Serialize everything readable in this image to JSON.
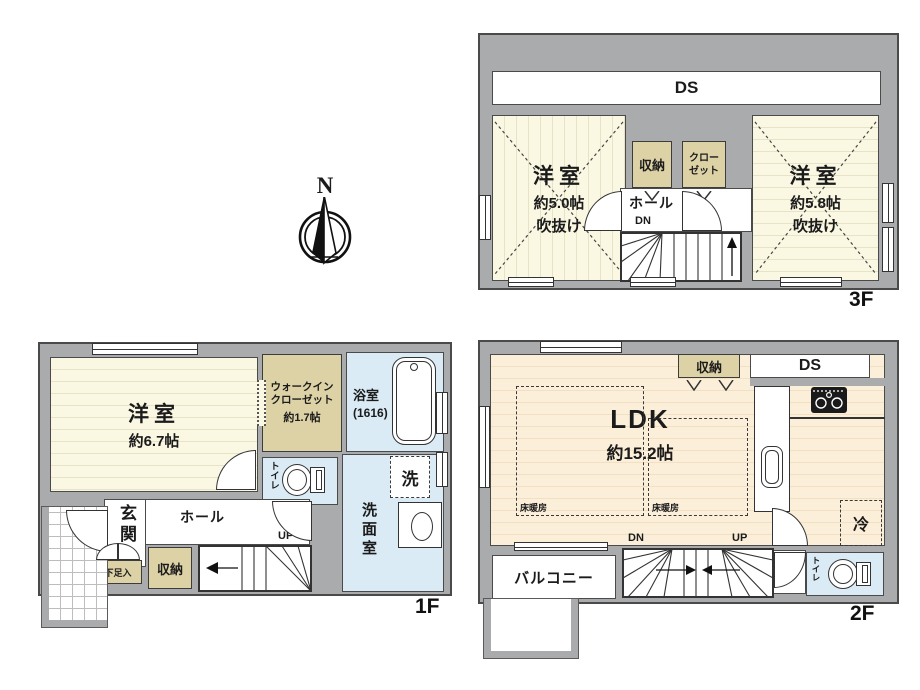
{
  "compass": {
    "north_label": "N"
  },
  "floor_3f": {
    "floor_label": "3F",
    "ds_label": "DS",
    "room_left": {
      "name": "洋室",
      "size": "約5.0帖",
      "void": "吹抜け"
    },
    "room_right": {
      "name": "洋室",
      "size": "約5.8帖",
      "void": "吹抜け"
    },
    "storage_label": "収納",
    "closet_line1": "クロー",
    "closet_line2": "ゼット",
    "hall_label": "ホール",
    "down_label": "DN"
  },
  "floor_1f": {
    "floor_label": "1F",
    "room": {
      "name": "洋室",
      "size": "約6.7帖"
    },
    "wic_line1": "ウォークイン",
    "wic_line2": "クローゼット",
    "wic_size": "約1.7帖",
    "bath_name": "浴室",
    "bath_size": "(1616)",
    "toilet_label": "トイレ",
    "laundry_label": "洗",
    "washroom_label": "洗面室",
    "entrance_label": "玄関",
    "hall_label": "ホール",
    "up_label": "UP",
    "shoe_label": "下足入",
    "storage_label": "収納"
  },
  "floor_2f": {
    "floor_label": "2F",
    "ldk": {
      "name": "LDK",
      "size": "約15.2帖"
    },
    "floor_heating_label": "床暖房",
    "storage_label": "収納",
    "ds_label": "DS",
    "fridge_label": "冷",
    "toilet_label": "トイレ",
    "balcony_label": "バルコニー",
    "down_label": "DN",
    "up_label": "UP"
  },
  "colors": {
    "wall": "#a9abad",
    "room_cream": "#faf7e3",
    "room_peach": "#fcefda",
    "storage_tan": "#ddd1a6",
    "wet_blue": "#daebf6"
  }
}
